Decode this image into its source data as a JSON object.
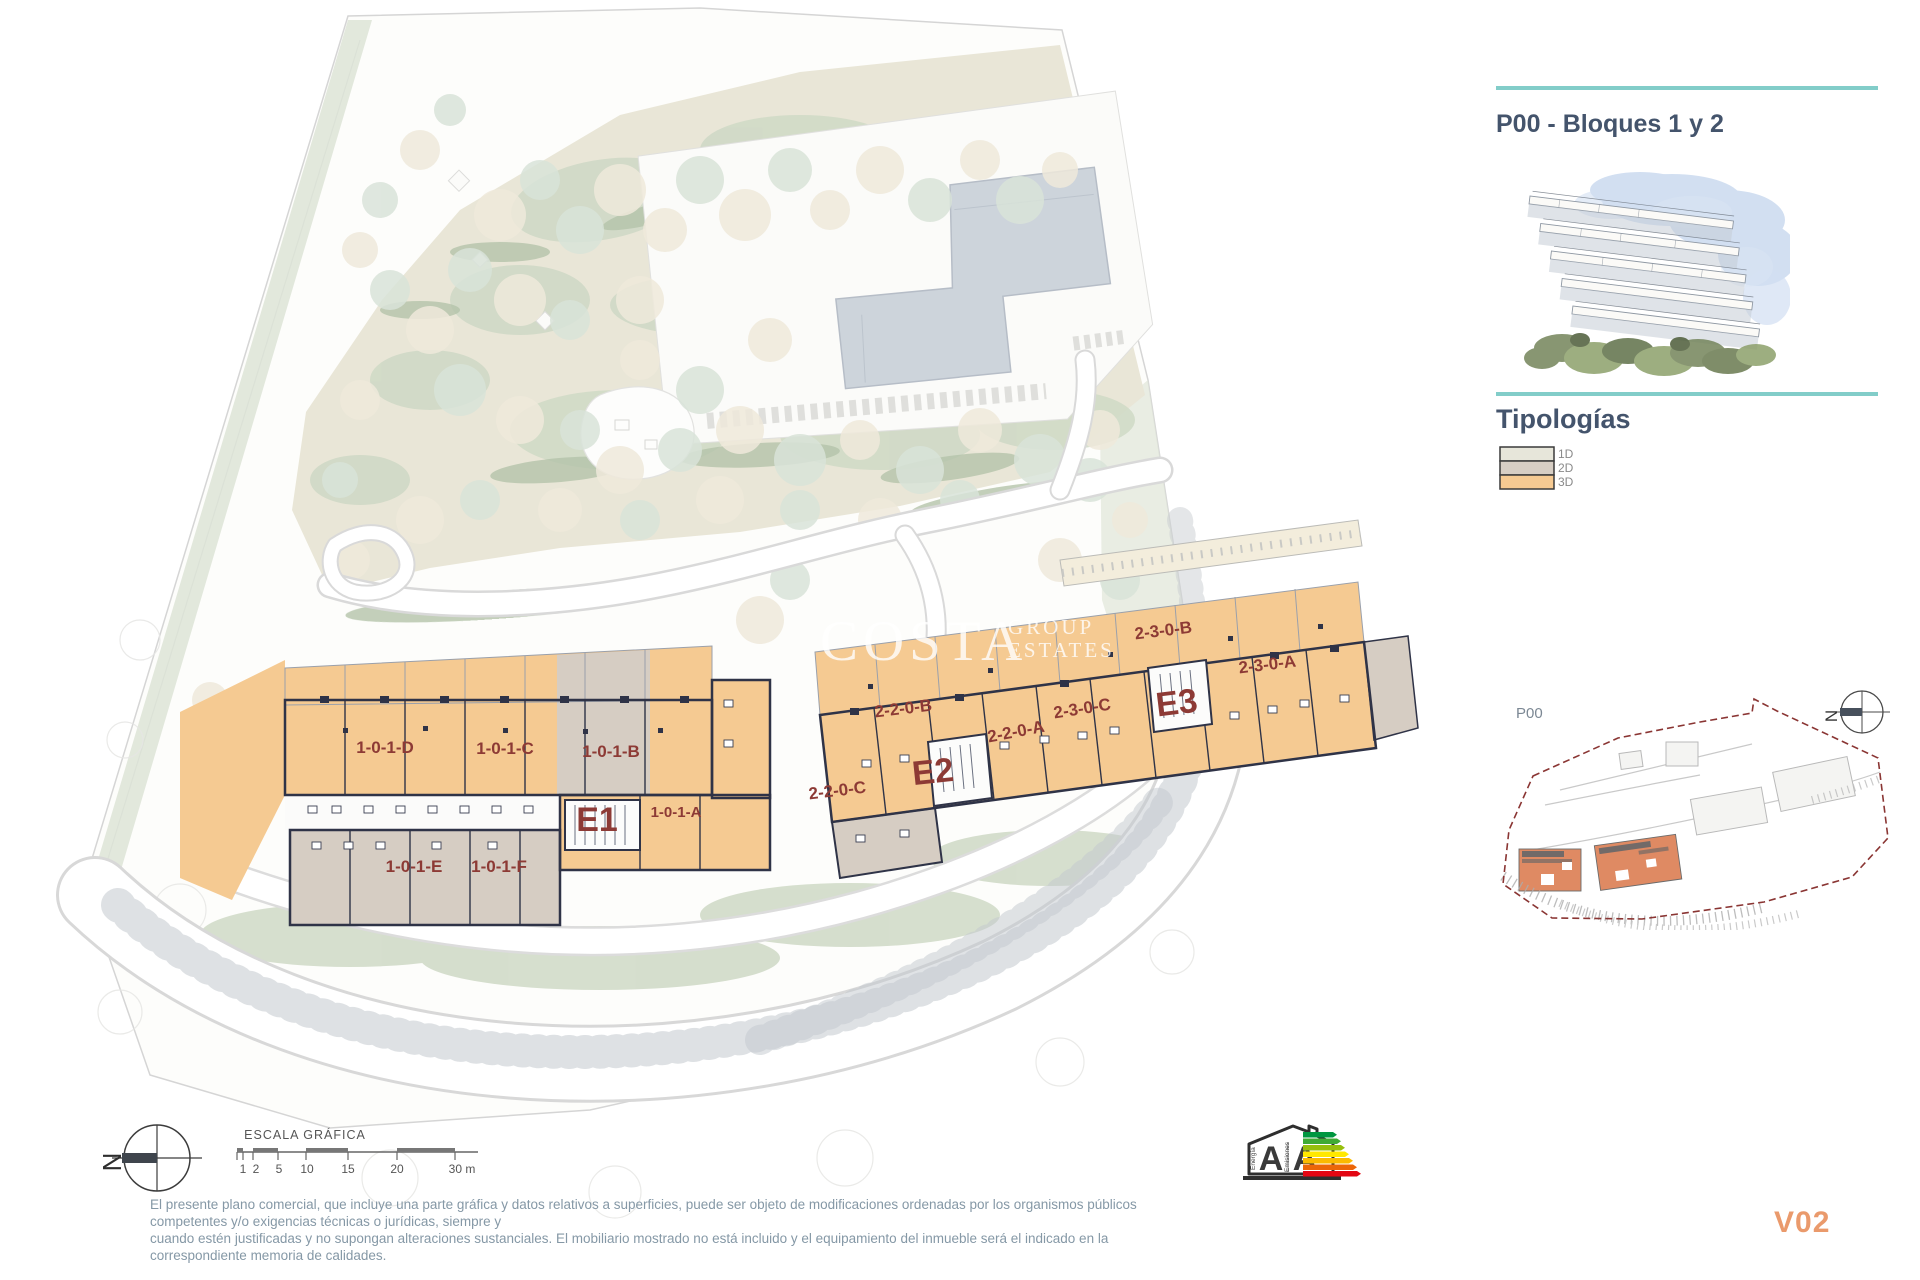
{
  "sidebar": {
    "title": "P00 - Bloques 1 y 2",
    "section_heading": "Tipologías",
    "legend": [
      {
        "label": "1D",
        "color": "#e7e6da"
      },
      {
        "label": "2D",
        "color": "#d7cec4"
      },
      {
        "label": "3D",
        "color": "#f6ca92"
      }
    ],
    "minimap": {
      "label": "P00",
      "compass_letter": "N"
    },
    "accent_teal": "#82cdc9"
  },
  "plan": {
    "watermark": {
      "word1": "COSTA",
      "word2": "GROUP",
      "word3": "ESTATES"
    },
    "label_color": "#8d3a35",
    "block1": {
      "core": "E1",
      "units": [
        "1-0-1-D",
        "1-0-1-C",
        "1-0-1-B",
        "1-0-1-A",
        "1-0-1-E",
        "1-0-1-F"
      ]
    },
    "block2": {
      "cores": [
        "E2",
        "E3"
      ],
      "units": [
        "2-2-0-C",
        "2-2-0-B",
        "2-2-0-A",
        "2-3-0-C",
        "2-3-0-B",
        "2-3-0-A"
      ]
    }
  },
  "footer": {
    "compass_letter": "N",
    "scale": {
      "title": "ESCALA GRÁFICA",
      "ticks": [
        "1",
        "2",
        "5",
        "10",
        "15",
        "20",
        "30 m"
      ]
    },
    "energy": {
      "letter_left": "A",
      "letter_right": "A",
      "caption_left": "Energía",
      "caption_right": "Emisiones"
    },
    "disclaimer_line1": "El presente plano comercial, que incluye una parte gráfica y datos relativos a superficies, puede ser objeto de modificaciones ordenadas por los organismos públicos competentes y/o exigencias técnicas o jurídicas, siempre y",
    "disclaimer_line2": "cuando estén justificadas y no supongan alteraciones sustanciales. El mobiliario mostrado no está incluido y el equipamiento del inmueble será el indicado en la correspondiente memoria de calidades.",
    "version": "V02"
  }
}
